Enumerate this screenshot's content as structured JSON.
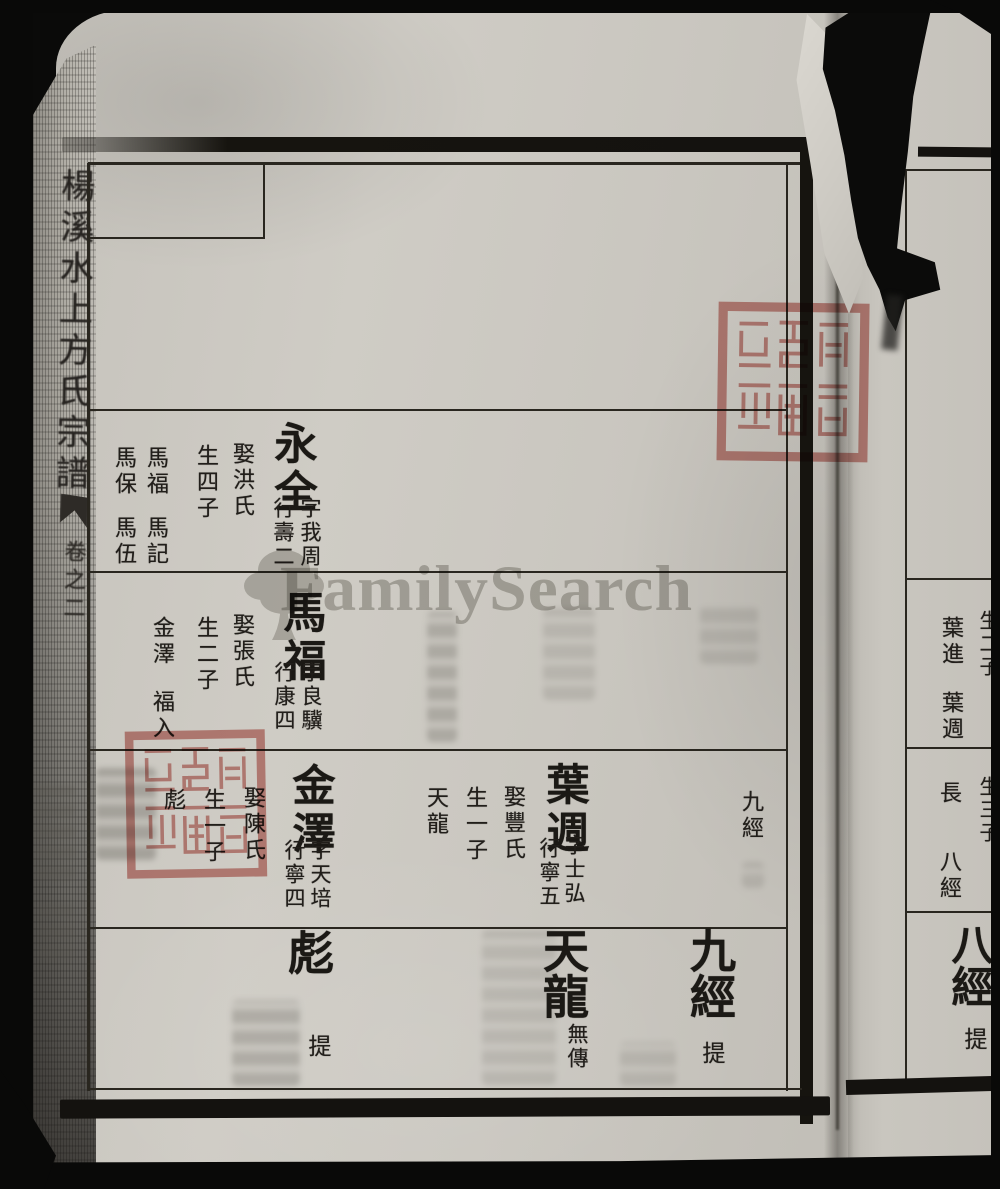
{
  "watermark": {
    "text": "FamilySearch"
  },
  "spine": {
    "title": "楊溪水上方氏宗譜",
    "volume": "卷之二"
  },
  "left_page": {
    "entries": [
      {
        "name": "永全",
        "zi": "字我周",
        "hang": "行壽二",
        "spouse": "娶洪氏",
        "sons_label": "生四子",
        "sons": [
          "馬福",
          "馬記",
          "馬保",
          "馬伍"
        ]
      },
      {
        "name": "馬福",
        "zi": "字良驥",
        "hang": "行康四",
        "spouse": "娶張氏",
        "sons_label": "生二子",
        "sons": [
          "金澤",
          "福入"
        ]
      },
      {
        "name": "金澤",
        "zi": "字天培",
        "hang": "行寧四",
        "spouse": "娶陳氏",
        "sons_label": "生一子",
        "sons": [
          "彪"
        ]
      },
      {
        "name": "葉週",
        "zi": "字士弘",
        "hang": "行寧五",
        "spouse": "娶豐氏",
        "sons_label": "生一子",
        "sons": [
          "天龍"
        ]
      }
    ],
    "side_ref": "九經",
    "band5": [
      {
        "name": "彪",
        "note": "提"
      },
      {
        "name": "天龍",
        "note": "無傳"
      },
      {
        "name": "九經",
        "note": "提"
      }
    ]
  },
  "right_page": {
    "sons_label_top": "生二子",
    "sons_top": [
      "葉進",
      "葉週"
    ],
    "sons_label_mid": "生三子",
    "eldest_label": "長",
    "eldest_name": "八經",
    "big_name": "八經",
    "big_note": "提"
  }
}
